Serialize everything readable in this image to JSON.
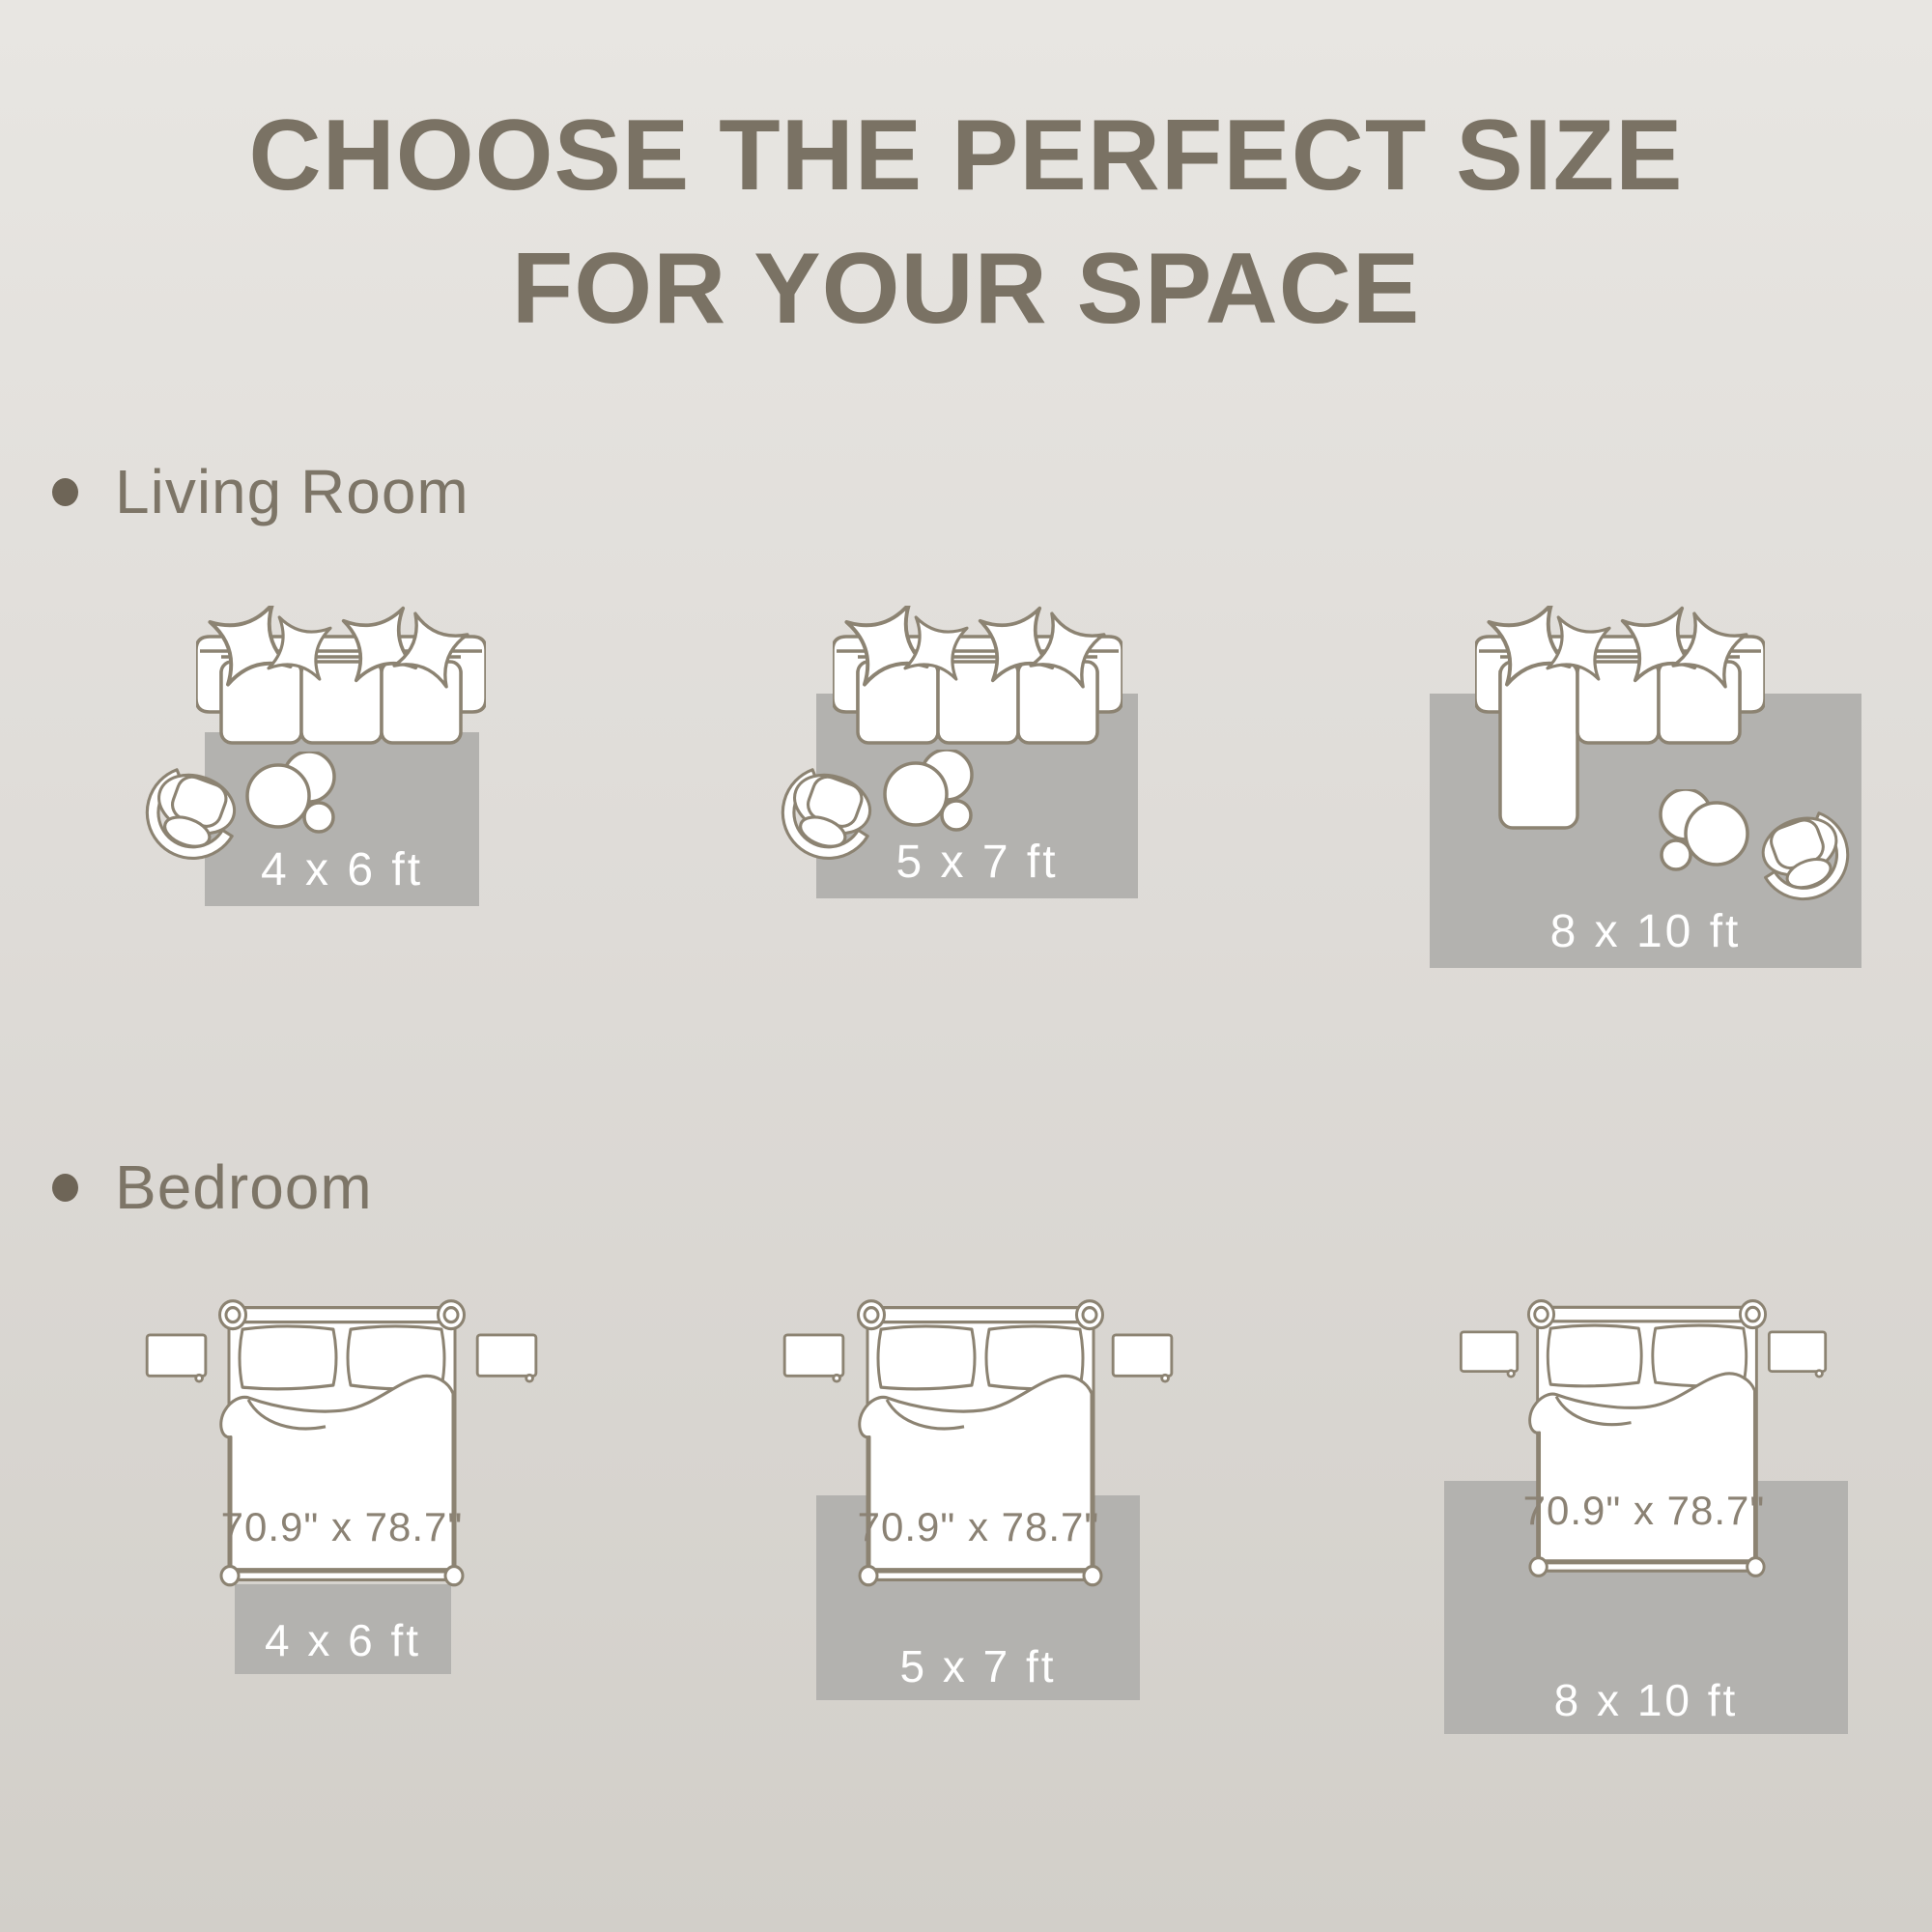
{
  "title": {
    "line1": "CHOOSE THE PERFECT SIZE",
    "line2": "FOR YOUR SPACE"
  },
  "sections": {
    "living_room": {
      "label": "Living Room",
      "rug_sizes": [
        "4 x 6 ft",
        "5 x 7 ft",
        "8 x 10 ft"
      ]
    },
    "bedroom": {
      "label": "Bedroom",
      "bed_size": "70.9\" x 78.7\"",
      "rug_sizes": [
        "4 x 6 ft",
        "5 x 7 ft",
        "8 x 10 ft"
      ]
    }
  },
  "colors": {
    "background_top": "#e8e6e2",
    "background_bottom": "#d2cfc9",
    "rug": "#b3b2af",
    "outline": "#8c8372",
    "title_text": "#7a7264",
    "label_text": "#7d7567",
    "bullet": "#6e6557",
    "dim_text": "#8b8274",
    "rug_label_text": "#ffffff"
  }
}
